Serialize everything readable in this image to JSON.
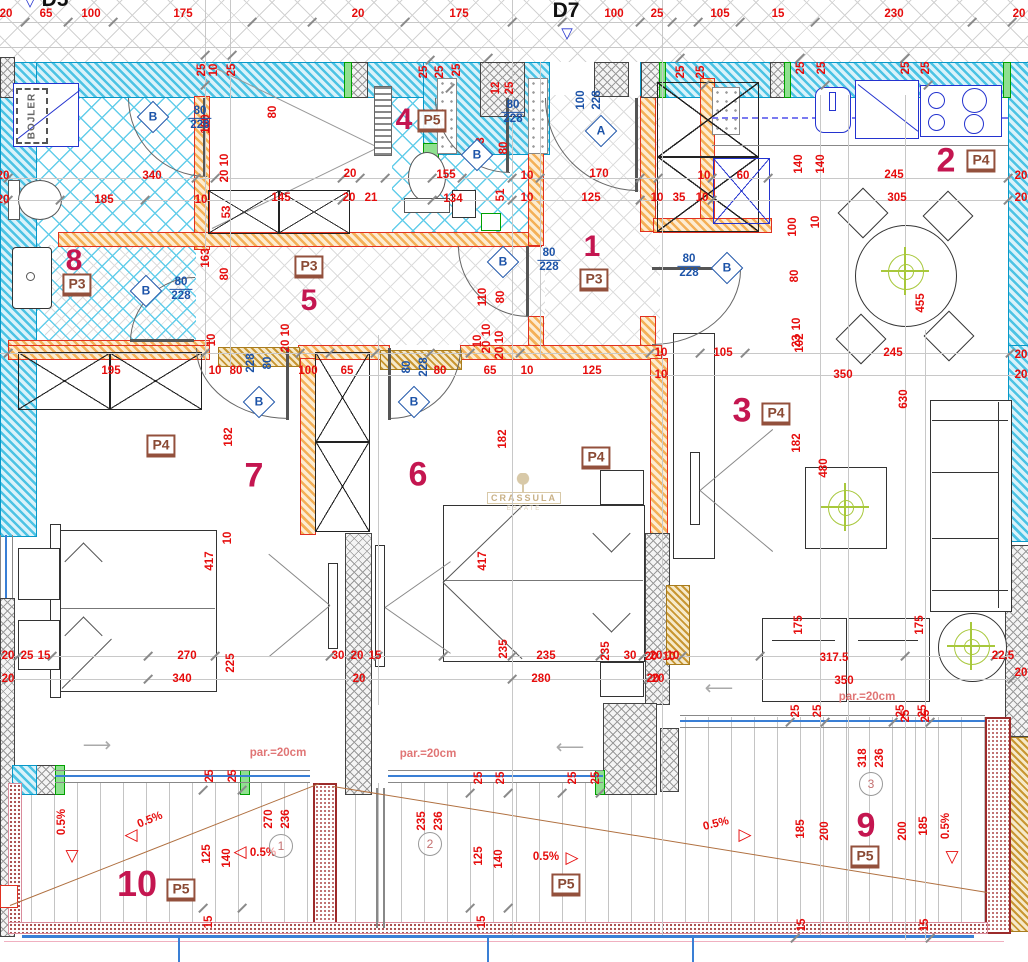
{
  "labels": {
    "d7": "D7",
    "d5": "D5",
    "bojler": "BOJLER",
    "watermark": "CRASSULA",
    "watermark_sub": "ESTATE"
  },
  "palette": {
    "dim_red": "#e60c0c",
    "room_crimson": "#c41650",
    "door_blue": "#1c53a8",
    "tag_brown": "#8a4a34",
    "wall_cyan": "#4cc3e4",
    "wall_orange": "#f4b057",
    "slope_brown": "#b07040",
    "rail_blue": "#3a7fd5"
  },
  "rooms": [
    {
      "n": "1",
      "nx": 592,
      "ny": 247,
      "fs": 30,
      "t": "P3",
      "tx": 594,
      "ty": 280
    },
    {
      "n": "2",
      "nx": 946,
      "ny": 161,
      "fs": 34,
      "t": "P4",
      "tx": 981,
      "ty": 161
    },
    {
      "n": "3",
      "nx": 742,
      "ny": 411,
      "fs": 34,
      "t": "P4",
      "tx": 776,
      "ty": 414
    },
    {
      "n": "4",
      "nx": 404,
      "ny": 120,
      "fs": 30,
      "t": "P5",
      "tx": 432,
      "ty": 121
    },
    {
      "n": "5",
      "nx": 309,
      "ny": 301,
      "fs": 30,
      "t": "P3",
      "tx": 309,
      "ty": 267
    },
    {
      "n": "6",
      "nx": 418,
      "ny": 475,
      "fs": 34,
      "t": "P4",
      "tx": 596,
      "ty": 458
    },
    {
      "n": "7",
      "nx": 254,
      "ny": 476,
      "fs": 34,
      "t": "P4",
      "tx": 161,
      "ty": 446
    },
    {
      "n": "8",
      "nx": 74,
      "ny": 261,
      "fs": 30,
      "t": "P3",
      "tx": 77,
      "ty": 285
    },
    {
      "n": "9",
      "nx": 866,
      "ny": 826,
      "fs": 34,
      "t": "P5",
      "tx": 865,
      "ty": 857
    },
    {
      "n": "10",
      "nx": 137,
      "ny": 884,
      "fs": 36,
      "t": "P5",
      "tx": 181,
      "ty": 890
    },
    {
      "n": "",
      "nx": 0,
      "ny": 0,
      "fs": 0,
      "t": "P5",
      "tx": 566,
      "ty": 885
    }
  ],
  "doors": [
    {
      "l": "A",
      "x": 601,
      "y": 131
    },
    {
      "l": "B",
      "x": 153,
      "y": 117
    },
    {
      "l": "B",
      "x": 477,
      "y": 155
    },
    {
      "l": "B",
      "x": 503,
      "y": 262
    },
    {
      "l": "B",
      "x": 727,
      "y": 268
    },
    {
      "l": "B",
      "x": 146,
      "y": 291
    },
    {
      "l": "B",
      "x": 259,
      "y": 402
    },
    {
      "l": "B",
      "x": 414,
      "y": 402
    }
  ],
  "fracs": [
    {
      "a": "80",
      "b": "228",
      "x": 200,
      "y": 118
    },
    {
      "a": "80",
      "b": "228",
      "x": 513,
      "y": 112
    },
    {
      "a": "80",
      "b": "228",
      "x": 549,
      "y": 260
    },
    {
      "a": "80",
      "b": "228",
      "x": 689,
      "y": 266
    },
    {
      "a": "80",
      "b": "228",
      "x": 181,
      "y": 289
    }
  ],
  "circled": [
    {
      "n": "1",
      "x": 281,
      "y": 846
    },
    {
      "n": "2",
      "x": 430,
      "y": 844
    },
    {
      "n": "3",
      "x": 871,
      "y": 784
    }
  ],
  "tris": [
    {
      "g": "▽",
      "x": 72,
      "y": 856
    },
    {
      "g": "◁",
      "x": 131,
      "y": 835
    },
    {
      "g": "◁",
      "x": 240,
      "y": 852
    },
    {
      "g": "▷",
      "x": 572,
      "y": 858
    },
    {
      "g": "▷",
      "x": 745,
      "y": 835
    },
    {
      "g": "▽",
      "x": 952,
      "y": 857
    }
  ],
  "swings": [
    {
      "g": "⟶",
      "x": 97,
      "y": 745
    },
    {
      "g": "⟵",
      "x": 570,
      "y": 747
    },
    {
      "g": "⟵",
      "x": 719,
      "y": 688
    }
  ],
  "lights": [
    {
      "x": 845,
      "y": 507
    },
    {
      "x": 971,
      "y": 646
    },
    {
      "x": 905,
      "y": 271
    }
  ],
  "dims": [
    [
      "20",
      6,
      14
    ],
    [
      "65",
      46,
      14
    ],
    [
      "100",
      91,
      14
    ],
    [
      "175",
      183,
      14
    ],
    [
      "20",
      358,
      14
    ],
    [
      "175",
      459,
      14
    ],
    [
      "100",
      614,
      14
    ],
    [
      "25",
      657,
      14
    ],
    [
      "105",
      720,
      14
    ],
    [
      "15",
      778,
      14
    ],
    [
      "230",
      894,
      14
    ],
    [
      "20",
      1019,
      14
    ],
    [
      "25",
      202,
      70,
      -90
    ],
    [
      "10",
      214,
      70,
      -90
    ],
    [
      "25",
      232,
      70,
      -90
    ],
    [
      "25",
      424,
      72,
      -90
    ],
    [
      "25",
      440,
      72,
      -90
    ],
    [
      "25",
      457,
      70,
      -90
    ],
    [
      "12",
      496,
      88,
      -90
    ],
    [
      "25",
      510,
      88,
      -90
    ],
    [
      "25",
      681,
      72,
      -90
    ],
    [
      "25",
      701,
      72,
      -90
    ],
    [
      "25",
      801,
      68,
      -90
    ],
    [
      "25",
      822,
      68,
      -90
    ],
    [
      "25",
      906,
      68,
      -90
    ],
    [
      "25",
      926,
      68,
      -90
    ],
    [
      "100",
      206,
      124,
      -90
    ],
    [
      "80",
      273,
      112,
      -90
    ],
    [
      "10",
      225,
      160,
      -90
    ],
    [
      "20",
      225,
      176,
      -90
    ],
    [
      "340",
      152,
      176
    ],
    [
      "185",
      104,
      200
    ],
    [
      "10",
      201,
      200
    ],
    [
      "20",
      3,
      176
    ],
    [
      "20",
      3,
      200
    ],
    [
      "163",
      206,
      258,
      -90
    ],
    [
      "80",
      225,
      274,
      -90
    ],
    [
      "53",
      227,
      212,
      -90
    ],
    [
      "10",
      286,
      330,
      -90
    ],
    [
      "20",
      286,
      346,
      -90
    ],
    [
      "145",
      281,
      198
    ],
    [
      "20",
      350,
      174
    ],
    [
      "20",
      349,
      198
    ],
    [
      "21",
      371,
      198
    ],
    [
      "155",
      446,
      175
    ],
    [
      "134",
      453,
      199
    ],
    [
      "10",
      527,
      176
    ],
    [
      "10",
      527,
      198
    ],
    [
      "143",
      481,
      147,
      -90
    ],
    [
      "80",
      504,
      148,
      -90
    ],
    [
      "51",
      501,
      195,
      -90
    ],
    [
      "110",
      483,
      297,
      -90
    ],
    [
      "80",
      501,
      297,
      -90
    ],
    [
      "10",
      487,
      330,
      -90
    ],
    [
      "20",
      487,
      347,
      -90
    ],
    [
      "170",
      599,
      174
    ],
    [
      "125",
      591,
      198
    ],
    [
      "10",
      657,
      198
    ],
    [
      "35",
      679,
      198
    ],
    [
      "10",
      702,
      198
    ],
    [
      "10",
      704,
      176
    ],
    [
      "60",
      743,
      176
    ],
    [
      "140",
      799,
      164,
      -90
    ],
    [
      "140",
      821,
      164,
      -90
    ],
    [
      "245",
      894,
      175
    ],
    [
      "305",
      897,
      198
    ],
    [
      "20",
      1021,
      176
    ],
    [
      "20",
      1021,
      198
    ],
    [
      "100",
      793,
      227,
      -90
    ],
    [
      "10",
      816,
      222,
      -90
    ],
    [
      "80",
      795,
      276,
      -90
    ],
    [
      "10",
      797,
      324,
      -90
    ],
    [
      "23",
      797,
      341,
      -90
    ],
    [
      "455",
      921,
      303,
      -90
    ],
    [
      "245",
      893,
      353
    ],
    [
      "350",
      843,
      375
    ],
    [
      "630",
      904,
      399,
      -90
    ],
    [
      "102",
      800,
      343,
      -90
    ],
    [
      "20",
      1021,
      355
    ],
    [
      "20",
      1021,
      375
    ],
    [
      "10",
      661,
      353
    ],
    [
      "10",
      661,
      375
    ],
    [
      "105",
      723,
      353
    ],
    [
      "182",
      797,
      443,
      -90
    ],
    [
      "480",
      824,
      468,
      -90
    ],
    [
      "175",
      799,
      625,
      -90
    ],
    [
      "175",
      920,
      625,
      -90
    ],
    [
      "317.5",
      834,
      658
    ],
    [
      "350",
      844,
      681
    ],
    [
      "20",
      651,
      657
    ],
    [
      "10",
      669,
      657
    ],
    [
      "20",
      653,
      679
    ],
    [
      "22.5",
      1003,
      656
    ],
    [
      "20",
      1021,
      673
    ],
    [
      "25",
      906,
      716,
      -90
    ],
    [
      "25",
      926,
      716,
      -90
    ],
    [
      "195",
      111,
      371
    ],
    [
      "10",
      215,
      371
    ],
    [
      "80",
      236,
      371
    ],
    [
      "100",
      308,
      371
    ],
    [
      "65",
      347,
      371
    ],
    [
      "228",
      251,
      363,
      -90,
      "b"
    ],
    [
      "80",
      268,
      363,
      -90,
      "b"
    ],
    [
      "182",
      229,
      437,
      -90
    ],
    [
      "417",
      210,
      561,
      -90
    ],
    [
      "10",
      228,
      538,
      -90
    ],
    [
      "270",
      187,
      656
    ],
    [
      "340",
      182,
      679
    ],
    [
      "225",
      231,
      663,
      -90
    ],
    [
      "20",
      8,
      656
    ],
    [
      "25",
      27,
      656
    ],
    [
      "15",
      44,
      656
    ],
    [
      "20",
      8,
      679
    ],
    [
      "30",
      338,
      656
    ],
    [
      "10",
      212,
      340,
      -90
    ],
    [
      "80",
      407,
      367,
      -90,
      "b"
    ],
    [
      "228",
      424,
      367,
      -90,
      "b"
    ],
    [
      "80",
      440,
      371
    ],
    [
      "65",
      490,
      371
    ],
    [
      "10",
      527,
      371
    ],
    [
      "125",
      592,
      371
    ],
    [
      "10",
      478,
      341,
      -90
    ],
    [
      "10",
      500,
      337,
      -90
    ],
    [
      "20",
      500,
      353,
      -90
    ],
    [
      "182",
      503,
      439,
      -90
    ],
    [
      "417",
      483,
      561,
      -90
    ],
    [
      "235",
      504,
      649,
      -90
    ],
    [
      "235",
      546,
      656
    ],
    [
      "280",
      541,
      679
    ],
    [
      "20",
      357,
      656
    ],
    [
      "15",
      375,
      656
    ],
    [
      "20",
      359,
      679
    ],
    [
      "235",
      606,
      651,
      -90
    ],
    [
      "30",
      630,
      656
    ],
    [
      "20",
      656,
      656
    ],
    [
      "10",
      673,
      656
    ],
    [
      "20",
      658,
      679
    ],
    [
      "100",
      581,
      100,
      -90,
      "b"
    ],
    [
      "228",
      597,
      100,
      -90,
      "b"
    ],
    [
      "25",
      210,
      776,
      -90
    ],
    [
      "25",
      233,
      776,
      -90
    ],
    [
      "25",
      479,
      778,
      -90
    ],
    [
      "25",
      501,
      778,
      -90
    ],
    [
      "25",
      573,
      778,
      -90
    ],
    [
      "25",
      596,
      778,
      -90
    ],
    [
      "25",
      796,
      711,
      -90
    ],
    [
      "25",
      818,
      711,
      -90
    ],
    [
      "25",
      901,
      711,
      -90
    ],
    [
      "25",
      923,
      711,
      -90
    ],
    [
      "125",
      207,
      854,
      -90
    ],
    [
      "140",
      227,
      858,
      -90
    ],
    [
      "125",
      479,
      856,
      -90
    ],
    [
      "140",
      499,
      859,
      -90
    ],
    [
      "15",
      209,
      922,
      -90
    ],
    [
      "15",
      482,
      922,
      -90
    ],
    [
      "15",
      802,
      925,
      -90
    ],
    [
      "15",
      925,
      925,
      -90
    ],
    [
      "185",
      801,
      829,
      -90
    ],
    [
      "200",
      825,
      831,
      -90
    ],
    [
      "200",
      903,
      831,
      -90
    ],
    [
      "185",
      924,
      826,
      -90
    ],
    [
      "270",
      269,
      819,
      -90
    ],
    [
      "236",
      286,
      819,
      -90
    ],
    [
      "235",
      422,
      821,
      -90
    ],
    [
      "236",
      439,
      821,
      -90
    ],
    [
      "318",
      863,
      758,
      -90
    ],
    [
      "236",
      880,
      758,
      -90
    ],
    [
      "par.=20cm",
      278,
      753,
      0,
      "p"
    ],
    [
      "par.=20cm",
      428,
      754,
      0,
      "p"
    ],
    [
      "par.=20cm",
      867,
      697,
      0,
      "p"
    ],
    [
      "0.5%",
      62,
      822,
      -90
    ],
    [
      "0.5%",
      150,
      820,
      -22
    ],
    [
      "0.5%",
      263,
      853
    ],
    [
      "0.5%",
      546,
      857
    ],
    [
      "0.5%",
      716,
      824,
      -14
    ],
    [
      "0.5%",
      946,
      826,
      -90
    ]
  ],
  "ticks": [
    [
      25,
      22
    ],
    [
      68,
      22
    ],
    [
      113,
      22
    ],
    [
      252,
      22
    ],
    [
      312,
      22
    ],
    [
      405,
      22
    ],
    [
      512,
      22
    ],
    [
      562,
      22
    ],
    [
      640,
      22
    ],
    [
      672,
      22
    ],
    [
      698,
      22
    ],
    [
      740,
      22
    ],
    [
      815,
      22
    ],
    [
      972,
      22
    ],
    [
      1012,
      22
    ],
    [
      205,
      55
    ],
    [
      232,
      55
    ],
    [
      205,
      85
    ],
    [
      430,
      60
    ],
    [
      450,
      88
    ],
    [
      488,
      58
    ],
    [
      680,
      58
    ],
    [
      705,
      85
    ],
    [
      800,
      58
    ],
    [
      825,
      85
    ],
    [
      905,
      58
    ],
    [
      928,
      85
    ],
    [
      8,
      178
    ],
    [
      196,
      178
    ],
    [
      215,
      178
    ],
    [
      342,
      178
    ],
    [
      360,
      178
    ],
    [
      385,
      178
    ],
    [
      432,
      178
    ],
    [
      462,
      178
    ],
    [
      512,
      178
    ],
    [
      540,
      178
    ],
    [
      640,
      178
    ],
    [
      658,
      178
    ],
    [
      712,
      178
    ],
    [
      768,
      178
    ],
    [
      1008,
      178
    ],
    [
      8,
      200
    ],
    [
      60,
      200
    ],
    [
      145,
      200
    ],
    [
      342,
      200
    ],
    [
      432,
      200
    ],
    [
      512,
      200
    ],
    [
      640,
      200
    ],
    [
      712,
      200
    ],
    [
      1008,
      200
    ],
    [
      8,
      353
    ],
    [
      205,
      353
    ],
    [
      300,
      353
    ],
    [
      330,
      353
    ],
    [
      375,
      353
    ],
    [
      430,
      353
    ],
    [
      470,
      353
    ],
    [
      520,
      353
    ],
    [
      650,
      353
    ],
    [
      700,
      353
    ],
    [
      745,
      353
    ],
    [
      1010,
      353
    ],
    [
      0,
      656
    ],
    [
      18,
      656
    ],
    [
      52,
      656
    ],
    [
      148,
      656
    ],
    [
      215,
      656
    ],
    [
      330,
      656
    ],
    [
      352,
      656
    ],
    [
      378,
      656
    ],
    [
      443,
      656
    ],
    [
      512,
      656
    ],
    [
      600,
      656
    ],
    [
      643,
      656
    ],
    [
      682,
      656
    ],
    [
      760,
      656
    ],
    [
      905,
      656
    ],
    [
      995,
      656
    ],
    [
      8,
      679
    ],
    [
      148,
      679
    ],
    [
      360,
      679
    ],
    [
      512,
      679
    ],
    [
      648,
      679
    ],
    [
      1012,
      679
    ],
    [
      203,
      790
    ],
    [
      242,
      790
    ],
    [
      470,
      793
    ],
    [
      508,
      793
    ],
    [
      562,
      793
    ],
    [
      600,
      793
    ],
    [
      790,
      722
    ],
    [
      825,
      722
    ],
    [
      893,
      722
    ],
    [
      930,
      722
    ],
    [
      203,
      908
    ],
    [
      242,
      908
    ],
    [
      470,
      908
    ],
    [
      508,
      908
    ],
    [
      795,
      938
    ],
    [
      930,
      938
    ]
  ],
  "hlines": [
    [
      22,
      0,
      1028
    ],
    [
      47,
      0,
      1028
    ],
    [
      178,
      0,
      1012
    ],
    [
      200,
      0,
      1012
    ],
    [
      353,
      0,
      1012
    ],
    [
      375,
      330,
      1028
    ],
    [
      656,
      0,
      1020
    ],
    [
      679,
      0,
      1020
    ]
  ],
  "vlines": [
    [
      512,
      0,
      935
    ],
    [
      540,
      62,
      358
    ],
    [
      662,
      0,
      935
    ],
    [
      820,
      95,
      935
    ],
    [
      848,
      95,
      935
    ],
    [
      905,
      95,
      940
    ],
    [
      925,
      330,
      940
    ],
    [
      205,
      0,
      375
    ],
    [
      230,
      0,
      375
    ],
    [
      378,
      335,
      705
    ]
  ]
}
